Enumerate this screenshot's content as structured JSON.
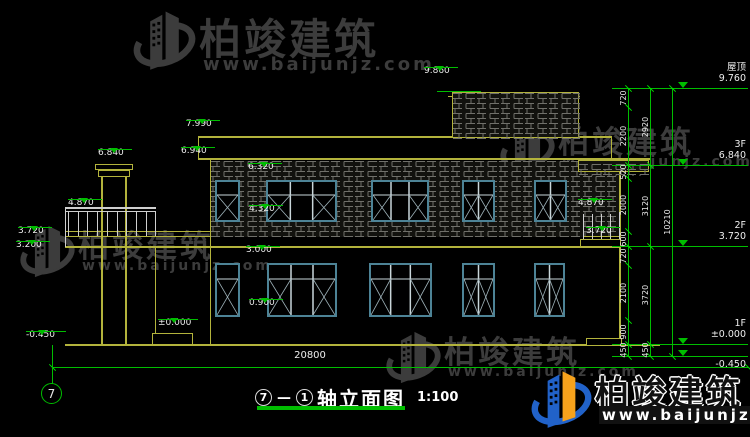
{
  "title": {
    "axis_start": "7",
    "axis_sep": "—",
    "axis_end": "1",
    "name": "轴立面图",
    "scale": "1:100"
  },
  "axis_bubble": "7",
  "bottom_dim": "20800",
  "colors": {
    "yellow": "#b3b33c",
    "green": "#00bd00",
    "white_line": "#cfcfcf",
    "teal": "#4d8396",
    "hatch": "#70706a",
    "wm_gray": "#3c3c3c",
    "wm_blue": "#2162c9",
    "wm_orange": "#f6a21c"
  },
  "watermark": {
    "brand": "柏竣建筑",
    "url": "www.baijunjz.com",
    "items": [
      {
        "x": 133,
        "y": 6,
        "icon": 66,
        "brandSize": 42,
        "urlSize": 18,
        "style": "gray"
      },
      {
        "x": 20,
        "y": 221,
        "icon": 58,
        "brandSize": 31,
        "urlSize": 14,
        "style": "gray"
      },
      {
        "x": 500,
        "y": 117,
        "icon": 58,
        "brandSize": 31,
        "urlSize": 14,
        "style": "gray"
      },
      {
        "x": 386,
        "y": 327,
        "icon": 58,
        "brandSize": 31,
        "urlSize": 14,
        "style": "gray"
      },
      {
        "x": 531,
        "y": 366,
        "icon": 64,
        "brandSize": 34,
        "urlSize": 15,
        "style": "color"
      }
    ]
  },
  "floor_levels": [
    {
      "name": "屋顶",
      "value": "9.760",
      "y": 88,
      "below": false
    },
    {
      "name": "3F",
      "value": "6.840",
      "y": 165,
      "below": false
    },
    {
      "name": "2F",
      "value": "3.720",
      "y": 246,
      "below": false
    },
    {
      "name": "1F",
      "value": "±0.000",
      "y": 344,
      "below": false
    },
    {
      "name": "",
      "value": "-0.450",
      "y": 356,
      "below": true
    }
  ],
  "elevation_marks": [
    {
      "value": "9.860",
      "x": 424,
      "y": 66
    },
    {
      "value": "7.990",
      "x": 186,
      "y": 119
    },
    {
      "value": "6.940",
      "x": 181,
      "y": 146
    },
    {
      "value": "6.840",
      "x": 98,
      "y": 148
    },
    {
      "value": "6.320",
      "x": 248,
      "y": 162
    },
    {
      "value": "4.870",
      "x": 68,
      "y": 198
    },
    {
      "value": "4.320",
      "x": 249,
      "y": 204
    },
    {
      "value": "3.720",
      "x": 18,
      "y": 226
    },
    {
      "value": "3.200",
      "x": 16,
      "y": 240
    },
    {
      "value": "4.870",
      "x": 578,
      "y": 198
    },
    {
      "value": "3.720",
      "x": 586,
      "y": 226
    },
    {
      "value": "3.000",
      "x": 246,
      "y": 245
    },
    {
      "value": "0.900",
      "x": 249,
      "y": 298
    },
    {
      "value": "±0.000",
      "x": 158,
      "y": 318
    },
    {
      "value": "-0.450",
      "x": 26,
      "y": 330
    }
  ],
  "dim_columns": [
    {
      "x": 628,
      "breaks": [
        88,
        107,
        165,
        178,
        231,
        246,
        265,
        320,
        344,
        356
      ],
      "labels": [
        "720",
        "2200",
        "520",
        "2000",
        "600",
        "720",
        "2100",
        "900",
        "450"
      ]
    },
    {
      "x": 650,
      "breaks": [
        88,
        165,
        246,
        344,
        356
      ],
      "labels": [
        "2920",
        "3120",
        "3720",
        "450"
      ]
    },
    {
      "x": 672,
      "breaks": [
        88,
        356
      ],
      "labels": [
        "10210"
      ]
    }
  ],
  "level_line": {
    "x1": 612,
    "x2": 748,
    "triX": 678
  },
  "penthouse_mark_line": {
    "x": 437,
    "y": 91,
    "w": 44,
    "triX": 452
  },
  "window_rows": [
    {
      "row": "2F",
      "y": 180,
      "h": 42,
      "transom": 13,
      "items": [
        {
          "x": 215,
          "w": 25,
          "cols": 1,
          "xp": [
            0
          ]
        },
        {
          "x": 266,
          "w": 71,
          "cols": 3,
          "xp": [
            0,
            2
          ]
        },
        {
          "x": 371,
          "w": 58,
          "cols": 3,
          "xp": [
            0,
            2
          ]
        },
        {
          "x": 462,
          "w": 33,
          "cols": 2,
          "xp": [
            0,
            1
          ]
        },
        {
          "x": 534,
          "w": 33,
          "cols": 2,
          "xp": [
            0,
            1
          ]
        }
      ]
    },
    {
      "row": "1F",
      "y": 263,
      "h": 54,
      "transom": 14,
      "items": [
        {
          "x": 215,
          "w": 25,
          "cols": 1,
          "xp": [
            0
          ]
        },
        {
          "x": 267,
          "w": 70,
          "cols": 3,
          "xp": [
            0,
            2
          ]
        },
        {
          "x": 369,
          "w": 63,
          "cols": 3,
          "xp": [
            0,
            2
          ]
        },
        {
          "x": 462,
          "w": 33,
          "cols": 2,
          "xp": [
            0,
            1
          ]
        },
        {
          "x": 534,
          "w": 31,
          "cols": 2,
          "xp": [
            0,
            1
          ]
        }
      ]
    }
  ],
  "lines": [
    {
      "n": "ground-line",
      "x": 65,
      "y": 344,
      "w": 595,
      "h": 2,
      "c": "Y"
    },
    {
      "n": "roof-parapet-top",
      "x": 198,
      "y": 136,
      "w": 414,
      "h": 2,
      "c": "Y"
    },
    {
      "n": "roof-eave-line",
      "x": 198,
      "y": 158,
      "w": 452,
      "h": 2,
      "c": "Y"
    },
    {
      "n": "roof-left-edge",
      "x": 198,
      "y": 136,
      "w": 1,
      "h": 24,
      "c": "Y"
    },
    {
      "n": "roof-right-edge",
      "x": 611,
      "y": 136,
      "w": 1,
      "h": 24,
      "c": "Y"
    },
    {
      "n": "penthouse-top-line",
      "x": 448,
      "y": 96,
      "w": 132,
      "h": 1,
      "c": "Y"
    },
    {
      "n": "porch-roof-top",
      "x": 65,
      "y": 231,
      "w": 147,
      "h": 1,
      "c": "Y"
    },
    {
      "n": "floor-band-top",
      "x": 65,
      "y": 236,
      "w": 555,
      "h": 1,
      "c": "Y"
    },
    {
      "n": "floor-band-bottom",
      "x": 65,
      "y": 246,
      "w": 555,
      "h": 2,
      "c": "Y"
    },
    {
      "n": "wall-left-edge",
      "x": 210,
      "y": 160,
      "w": 1,
      "h": 184,
      "c": "Y"
    },
    {
      "n": "wall-right-edge",
      "x": 619,
      "y": 172,
      "w": 2,
      "h": 172,
      "c": "Y"
    },
    {
      "n": "porch-back-wall",
      "x": 155,
      "y": 247,
      "w": 1,
      "h": 97,
      "c": "Y"
    },
    {
      "n": "lintel-line-2f",
      "x": 210,
      "y": 178,
      "w": 374,
      "h": 1,
      "c": "Y"
    },
    {
      "n": "chimney-left-edge",
      "x": 101,
      "y": 176,
      "w": 2,
      "h": 168,
      "c": "Y"
    },
    {
      "n": "chimney-right-edge",
      "x": 125,
      "y": 176,
      "w": 2,
      "h": 168,
      "c": "Y"
    },
    {
      "n": "porch-rail-top",
      "x": 65,
      "y": 207,
      "w": 91,
      "h": 2,
      "c": "W"
    },
    {
      "n": "porch-rail-mid",
      "x": 65,
      "y": 211,
      "w": 91,
      "h": 1,
      "c": "W"
    },
    {
      "n": "porch-left-post",
      "x": 65,
      "y": 207,
      "w": 1,
      "h": 40,
      "c": "W"
    },
    {
      "n": "balcony-rail-top",
      "x": 580,
      "y": 212,
      "w": 40,
      "h": 2,
      "c": "W"
    },
    {
      "n": "step-line-1",
      "x": 152,
      "y": 337,
      "w": 41,
      "h": 1,
      "c": "Y"
    },
    {
      "n": "step-line-2",
      "x": 152,
      "y": 341,
      "w": 41,
      "h": 1,
      "c": "Y"
    },
    {
      "n": "right-step-line",
      "x": 586,
      "y": 341,
      "w": 36,
      "h": 1,
      "c": "Y"
    }
  ],
  "boxes": [
    {
      "n": "chimney-cap-upper",
      "x": 95,
      "y": 164,
      "w": 38,
      "h": 6
    },
    {
      "n": "chimney-cap-lower",
      "x": 98,
      "y": 170,
      "w": 32,
      "h": 7
    },
    {
      "n": "entry-steps",
      "x": 152,
      "y": 333,
      "w": 41,
      "h": 12
    },
    {
      "n": "right-step",
      "x": 586,
      "y": 338,
      "w": 36,
      "h": 8
    },
    {
      "n": "balcony-slab",
      "x": 580,
      "y": 239,
      "w": 41,
      "h": 8
    }
  ],
  "hatches": [
    {
      "n": "penthouse-brick-wall",
      "x": 452,
      "y": 92,
      "w": 127,
      "h": 46,
      "border": true
    },
    {
      "n": "wall-brick-2f",
      "x": 211,
      "y": 161,
      "w": 372,
      "h": 76,
      "border": false
    },
    {
      "n": "wall-brick-2f-right",
      "x": 583,
      "y": 166,
      "w": 36,
      "h": 70,
      "border": false
    },
    {
      "n": "right-fascia-band",
      "x": 578,
      "y": 160,
      "w": 71,
      "h": 12,
      "border": true
    }
  ],
  "post_runs": [
    {
      "n": "porch-rail-post",
      "x0": 68,
      "step": 9.7,
      "count": 10,
      "y": 212,
      "h": 24
    },
    {
      "n": "balcony-rail-post",
      "x0": 583,
      "step": 9,
      "count": 5,
      "y": 214,
      "h": 25
    }
  ],
  "bottom_dim_line": {
    "x": 52,
    "y": 367,
    "w": 696
  },
  "axis_line": {
    "x": 52,
    "y": 345,
    "h": 39
  }
}
